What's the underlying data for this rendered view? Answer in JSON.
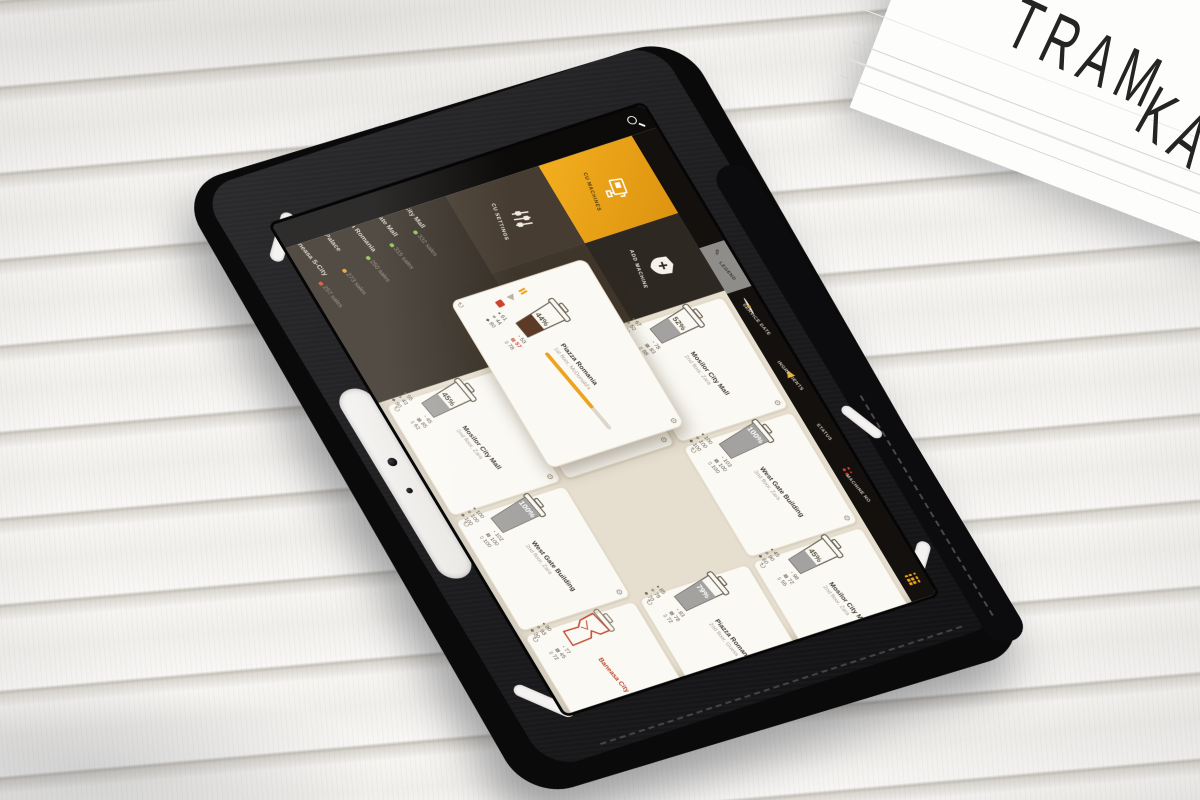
{
  "scene": {
    "frame": {
      "text_line1": "TRAM",
      "text_line2": "KAM"
    }
  },
  "ui": {
    "topbar": {
      "search_icon": "magnifier-icon"
    },
    "sidebar": {
      "items": [
        {
          "rank": "1.",
          "name": "Mosilor City Mall",
          "sales": "332 sales",
          "status_color": "#8bc34a"
        },
        {
          "rank": "2.",
          "name": "West Gate Mall",
          "sales": "315 sales",
          "status_color": "#8bc34a"
        },
        {
          "rank": "3.",
          "name": "Piazza Romania",
          "sales": "250 sales",
          "status_color": "#8bc34a"
        },
        {
          "rank": "4.",
          "name": "AFI Palace",
          "sales": "273 sales",
          "status_color": "#e8a020"
        },
        {
          "rank": "5.",
          "name": "Baneasa S-City",
          "sales": "257 sales",
          "status_color": "#d2502f"
        }
      ]
    },
    "tabs": [
      {
        "label": "CU SETTINGS",
        "icon": "sliders-icon",
        "active": false
      },
      {
        "label": "CU MACHINES",
        "icon": "coffee-machine-icon",
        "active": true
      },
      {
        "label": "HELP & SUPPORT",
        "icon": "lifebuoy-icon",
        "active": false
      },
      {
        "label": "ADD MACHINE",
        "icon": "add-pin-icon",
        "active": false
      }
    ],
    "legend": {
      "tab_label": "LEGEND",
      "tab_icon": "pencil-icon",
      "items": [
        {
          "label": "SERVICE DATE",
          "icon": "service-date-icon"
        },
        {
          "label": "INGREDIENTS",
          "icon": "ingredients-warning-icon"
        },
        {
          "label": "STATUS",
          "icon": "status-icon"
        },
        {
          "label": "MACHINE NO",
          "icon": "machine-no-icon"
        }
      ],
      "footer_icon": "grid-dots-icon"
    },
    "stat_icon_names": [
      "coffee-beans-icon",
      "service-clock-icon",
      "ice-icon",
      "sugar-icon",
      "milk-icon",
      "cups-icon"
    ],
    "cards": [
      {
        "name": "Mosilor City Mall",
        "location": "2nd floor, Zara",
        "fill_percent": 45,
        "fill_label": "45%",
        "stats": [
          55,
          45,
          43,
          85,
          90,
          62
        ],
        "variant": "normal"
      },
      {
        "name": "AFI Palace Center",
        "location": "2nd floor, Mango",
        "fill_percent": 11,
        "fill_label": "11%",
        "stats": [
          77,
          75,
          11,
          80,
          90,
          83
        ],
        "alert_stat": 2,
        "variant": "normal"
      },
      {
        "name": "Mosilor City Mall",
        "location": "2nd floor, Zara",
        "fill_percent": 52,
        "fill_label": "52%",
        "stats": [
          67,
          78,
          52,
          83,
          90,
          98
        ],
        "variant": "normal"
      },
      {
        "name": "West Gate Building",
        "location": "2nd floor, Zara",
        "fill_percent": 100,
        "fill_label": "100%",
        "stats": [
          100,
          102,
          100,
          100,
          100,
          100
        ],
        "variant": "normal"
      },
      {
        "name": "Piazza Romania",
        "location": "1st floor, McDonald's",
        "fill_percent": 44,
        "fill_label": "44%",
        "stats": [
          61,
          53,
          44,
          57,
          80,
          78
        ],
        "alert_stat": 3,
        "variant": "expanded",
        "progress_percent": 72
      },
      {
        "name": "West Gate Building",
        "location": "2nd floor, Zara",
        "fill_percent": 100,
        "fill_label": "100%",
        "stats": [
          100,
          103,
          100,
          100,
          100,
          100
        ],
        "variant": "normal"
      },
      {
        "name": "Baneasa City Mall",
        "location": "",
        "fill_percent": 0,
        "fill_label": "",
        "stats": [
          90,
          77,
          93,
          45,
          30,
          72
        ],
        "variant": "broken"
      },
      {
        "name": "Piazza Romania",
        "location": "2nd floor, Guess",
        "fill_percent": 79,
        "fill_label": "79%",
        "stats": [
          85,
          83,
          79,
          78,
          70,
          72
        ],
        "variant": "normal"
      },
      {
        "name": "Mosilor City Mall",
        "location": "2nd floor, Zara",
        "fill_percent": 45,
        "fill_label": "45%",
        "stats": [
          45,
          98,
          90,
          72,
          60,
          55
        ],
        "variant": "normal"
      }
    ],
    "colors": {
      "accent": "#eda31d",
      "alert": "#cd3f2b",
      "ok": "#8bc34a",
      "card_bg": "#fbf9f4",
      "screen_bg": "#e6dfd0",
      "sidebar_bg": "#372f26",
      "topbar_bg": "#0c0b0a",
      "cup_fill": "#a3a2a0",
      "cup_fill_coffee": "#5d3a26"
    }
  }
}
